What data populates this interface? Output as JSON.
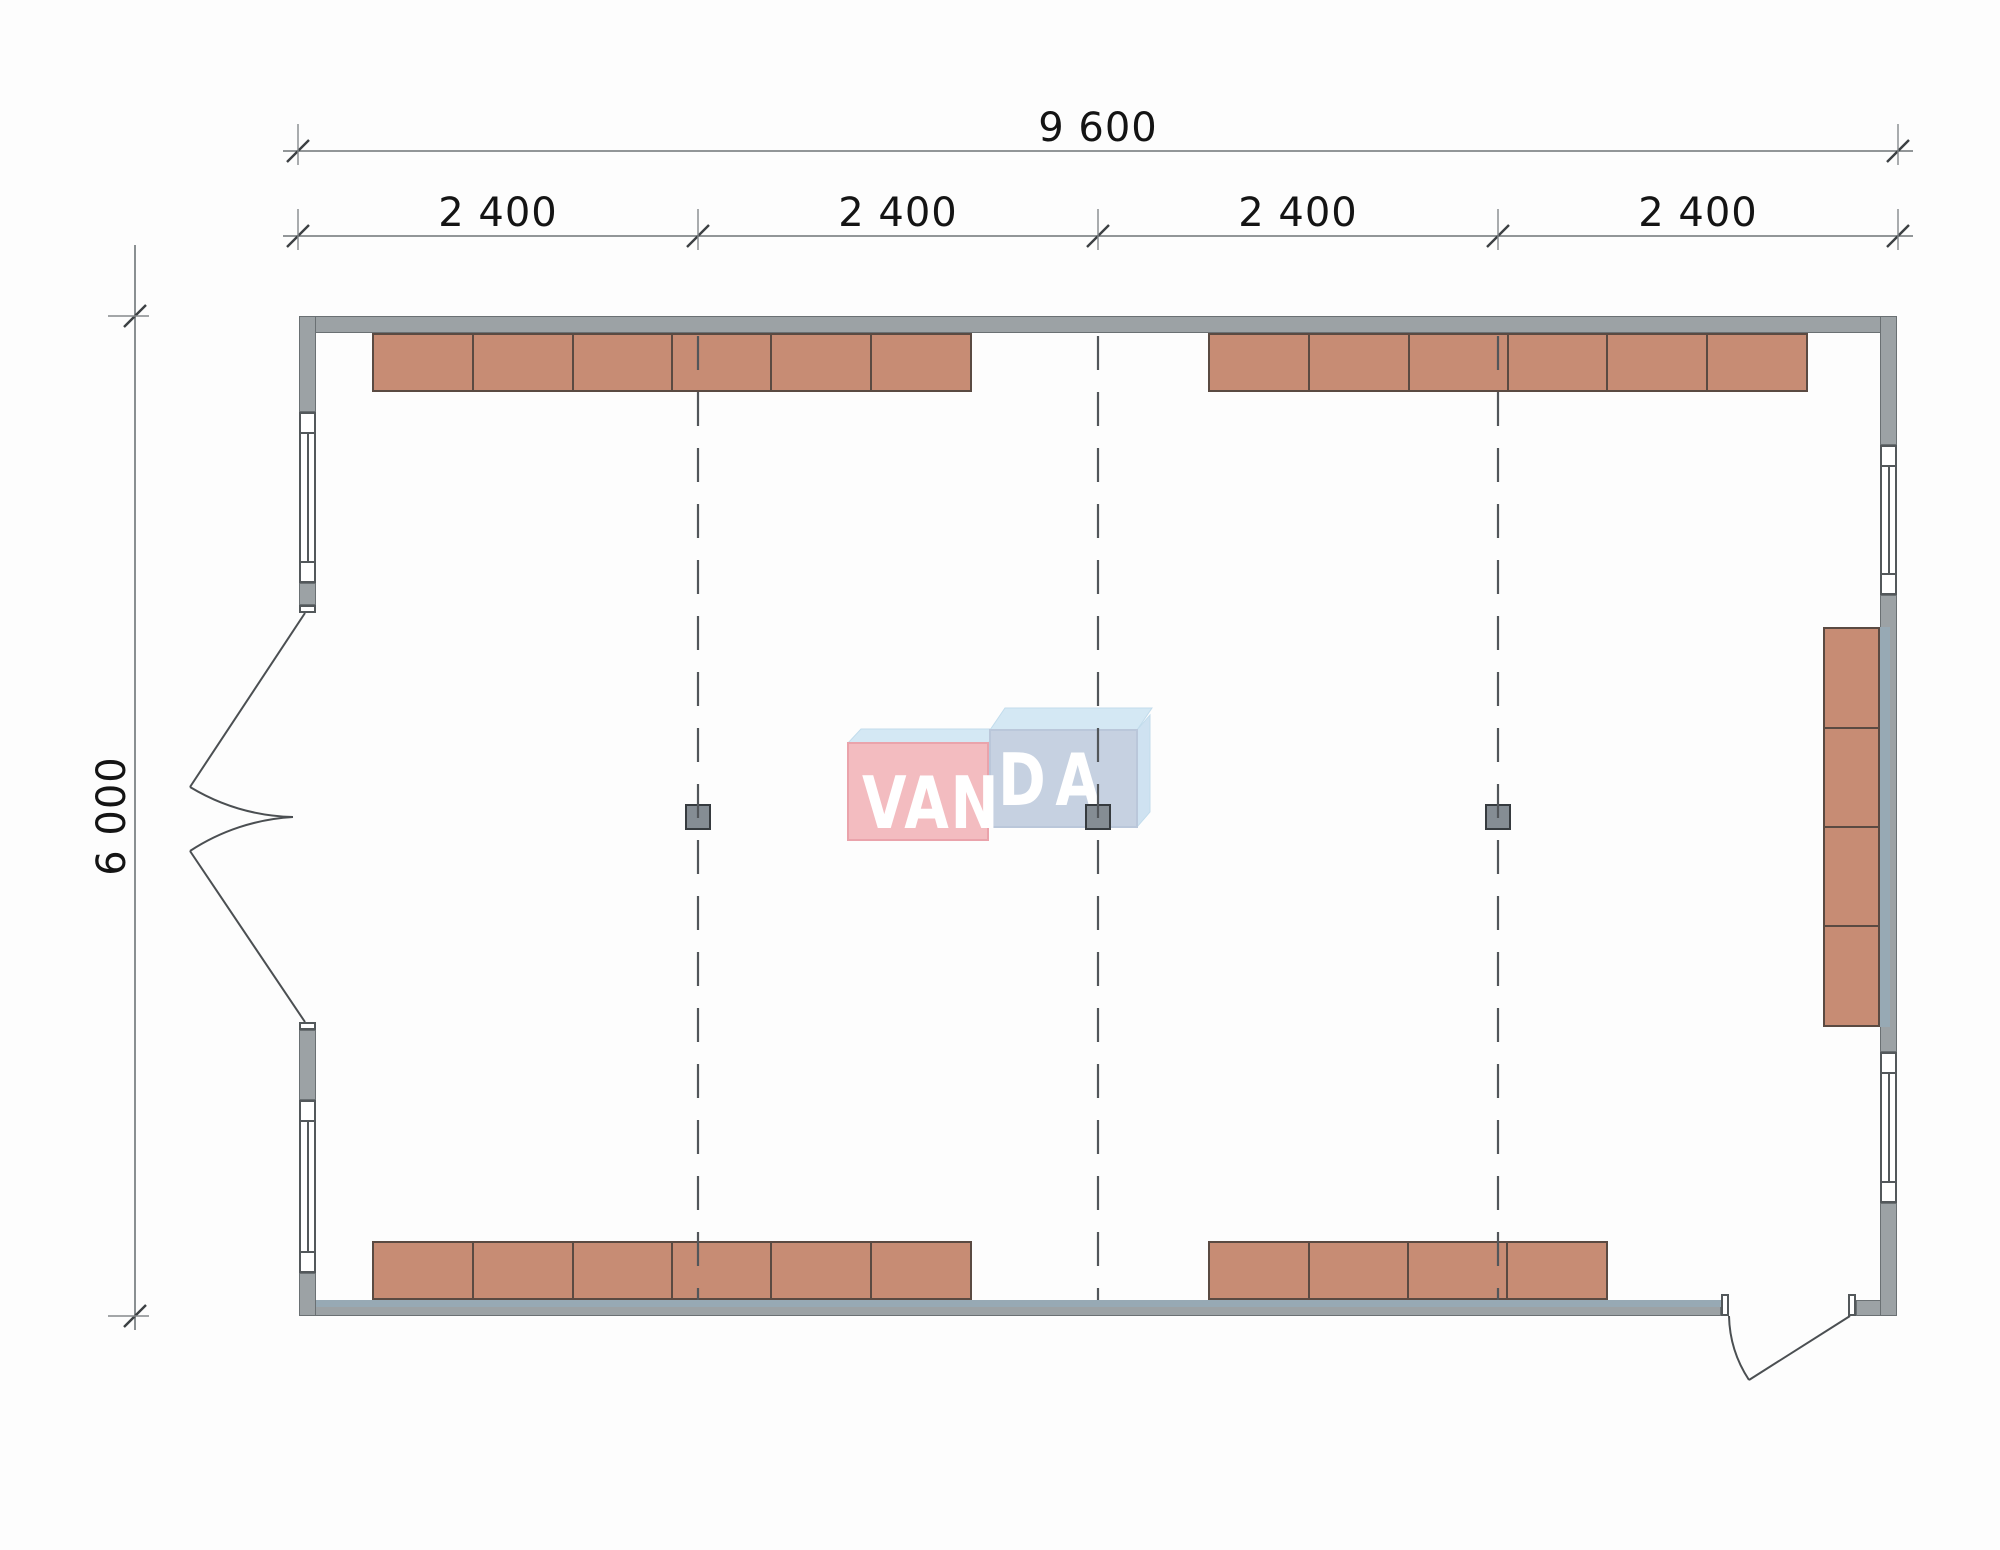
{
  "watermark": {
    "left_text": "VAN",
    "right_text": "DA",
    "pink_front": "#f3bcc0",
    "pink_border": "#eaa3ab",
    "blue_front": "#c6d1e1",
    "blue_border": "#bac7da",
    "top_face": "#d4e8f4",
    "side_face": "#cfe2f1"
  },
  "dimensions": {
    "overall_width": {
      "label": "9 600"
    },
    "bays": [
      {
        "label": "2 400"
      },
      {
        "label": "2 400"
      },
      {
        "label": "2 400"
      },
      {
        "label": "2 400"
      }
    ],
    "overall_height": {
      "label": "6 000"
    }
  },
  "plan": {
    "colors": {
      "wall_fill": "#9ca2a5",
      "wall_border": "#6a7073",
      "lining_fill": "#97a9b4",
      "cabinet_fill": "#c78c74",
      "cabinet_border": "#5a4a42",
      "column_fill": "#858d94",
      "column_border": "#363b3f",
      "line_dark": "#53585b",
      "dim_text": "#141414",
      "grid_line": "#52565a"
    },
    "walls": [
      {
        "x": 299,
        "y": 316,
        "w": 1598,
        "h": 17
      },
      {
        "x": 299,
        "y": 1300,
        "w": 1422,
        "h": 16
      },
      {
        "x": 1856,
        "y": 1300,
        "w": 41,
        "h": 16
      },
      {
        "x": 299,
        "y": 316,
        "w": 17,
        "h": 96
      },
      {
        "x": 299,
        "y": 583,
        "w": 17,
        "h": 22
      },
      {
        "x": 299,
        "y": 1030,
        "w": 17,
        "h": 70
      },
      {
        "x": 299,
        "y": 1273,
        "w": 17,
        "h": 43
      },
      {
        "x": 1880,
        "y": 316,
        "w": 17,
        "h": 129
      },
      {
        "x": 1880,
        "y": 595,
        "w": 17,
        "h": 457
      },
      {
        "x": 1880,
        "y": 1203,
        "w": 17,
        "h": 113
      }
    ],
    "wall_linings": [
      {
        "x": 316,
        "y": 1300,
        "w": 1405,
        "h": 7
      },
      {
        "x": 1880,
        "y": 627,
        "w": 10,
        "h": 400
      }
    ],
    "windows": [
      {
        "x": 299,
        "y": 412,
        "w": 17,
        "h": 171
      },
      {
        "x": 299,
        "y": 1100,
        "w": 17,
        "h": 173
      },
      {
        "x": 1880,
        "y": 445,
        "w": 17,
        "h": 150
      },
      {
        "x": 1880,
        "y": 1052,
        "w": 17,
        "h": 151
      }
    ],
    "door_jambs": [
      {
        "x": 299,
        "y": 605,
        "w": 17,
        "h": 8
      },
      {
        "x": 299,
        "y": 1022,
        "w": 17,
        "h": 8
      },
      {
        "x": 1721,
        "y": 1294,
        "w": 8,
        "h": 22
      },
      {
        "x": 1848,
        "y": 1294,
        "w": 8,
        "h": 22
      }
    ],
    "cabinet_runs": [
      {
        "name": "top-left",
        "x": 372,
        "y": 333,
        "w": 600,
        "h": 59,
        "orient": "h",
        "units": 6
      },
      {
        "name": "top-right",
        "x": 1208,
        "y": 333,
        "w": 600,
        "h": 59,
        "orient": "h",
        "units": 6
      },
      {
        "name": "bottom-left",
        "x": 372,
        "y": 1241,
        "w": 600,
        "h": 59,
        "orient": "h",
        "units": 6
      },
      {
        "name": "bottom-right",
        "x": 1208,
        "y": 1241,
        "w": 400,
        "h": 59,
        "orient": "h",
        "units": 4
      },
      {
        "name": "right-wall",
        "x": 1823,
        "y": 627,
        "w": 57,
        "h": 400,
        "orient": "v",
        "units": 4
      }
    ],
    "columns": [
      {
        "cx": 698,
        "cy": 817
      },
      {
        "cx": 1098,
        "cy": 817
      },
      {
        "cx": 1498,
        "cy": 817
      }
    ],
    "grid_lines_x": [
      698,
      1098,
      1498
    ]
  }
}
